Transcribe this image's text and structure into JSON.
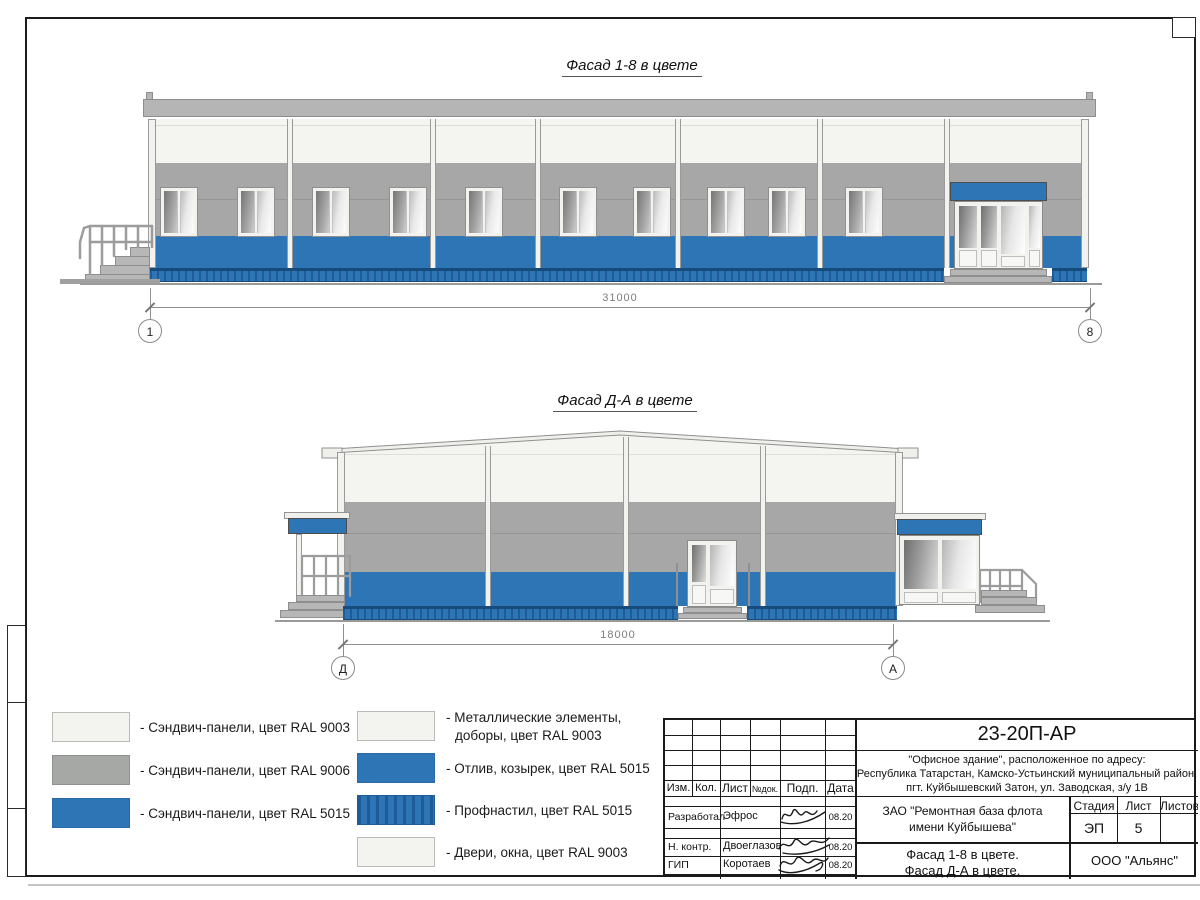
{
  "page": {
    "facade1": {
      "title": "Фасад 1-8 в цвете",
      "dimension": "31000",
      "axis_left": "1",
      "axis_right": "8"
    },
    "facade2": {
      "title": "Фасад Д-А в цвете",
      "dimension": "18000",
      "axis_left": "Д",
      "axis_right": "А"
    },
    "legend": {
      "left": [
        {
          "label": "- Сэндвич-панели, цвет RAL 9003",
          "swatch": "white"
        },
        {
          "label": "- Сэндвич-панели, цвет RAL 9006",
          "swatch": "gray"
        },
        {
          "label": "- Сэндвич-панели, цвет RAL 5015",
          "swatch": "blue"
        }
      ],
      "right": [
        {
          "label1": "- Металлические элементы,",
          "label2": "доборы, цвет RAL 9003",
          "swatch": "white"
        },
        {
          "label1": "- Отлив, козырек, цвет RAL 5015",
          "label2": "",
          "swatch": "blue"
        },
        {
          "label1": "- Профнастил, цвет RAL 5015",
          "label2": "",
          "swatch": "striped"
        },
        {
          "label1": "- Двери, окна, цвет RAL 9003",
          "label2": "",
          "swatch": "white"
        }
      ]
    },
    "titleblock": {
      "doc_number": "23-20П-АР",
      "address1": "\"Офисное здание\", расположенное по адресу:",
      "address2": "Республика Татарстан, Камско-Устьинский муниципальный район,",
      "address3": "пгт. Куйбышевский Затон, ул. Заводская, з/у 1В",
      "col_izm": "Изм.",
      "col_kol": "Кол.",
      "col_list": "Лист",
      "col_ndok": "№док.",
      "col_podp": "Подп.",
      "col_data": "Дата",
      "row1_role": "Разработал",
      "row1_name": "Эфрос",
      "row1_date": "08.20",
      "row2_role": "Н. контр.",
      "row2_name": "Двоеглазов",
      "row2_date": "08.20",
      "row3_role": "ГИП",
      "row3_name": "Коротаев",
      "row3_date": "08.20",
      "client1": "ЗАО \"Ремонтная база флота",
      "client2": "имени Куйбышева\"",
      "sheet_title1": "Фасад 1-8 в цвете.",
      "sheet_title2": "Фасад Д-А в цвете.",
      "stage_label": "Стадия",
      "list_label": "Лист",
      "listov_label": "Листов",
      "stage_value": "ЭП",
      "list_value": "5",
      "company": "ООО \"Альянс\""
    },
    "colors": {
      "facade_blue": "#2e75b6",
      "profnastil_dark": "#1d5c97",
      "facade_gray": "#a7a7a7",
      "facade_white": "#f4f5f1"
    }
  }
}
